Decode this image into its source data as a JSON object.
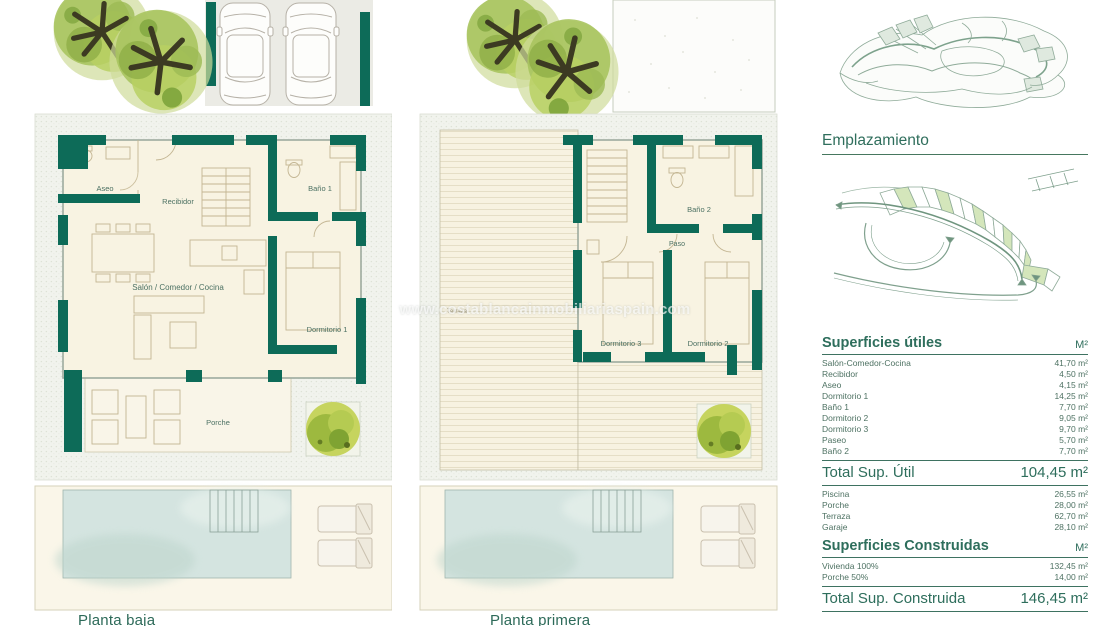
{
  "colors": {
    "wall_teal": "#0d6b58",
    "heading_teal": "#2f6e5c",
    "table_text": "#4e7263",
    "floor_cream": "#f8f3e2",
    "pool_blue": "#d4e4e0",
    "plot_speckle": "#f1f3ed",
    "map_line": "#8fab99",
    "plot_highlight": "#cfe3b0"
  },
  "plans": {
    "plan1": {
      "label": "Planta baja",
      "rooms": {
        "aseo": "Aseo",
        "recibidor": "Recibidor",
        "bano1": "Baño 1",
        "salon": "Salón / Comedor / Cocina",
        "dormitorio1": "Dormitorio 1",
        "porche": "Porche"
      }
    },
    "plan2": {
      "label": "Planta primera",
      "rooms": {
        "terraza": "Terraza",
        "bano2": "Baño 2",
        "paso": "Paso",
        "dormitorio3": "Dormitorio 3",
        "dormitorio2": "Dormitorio 2"
      }
    }
  },
  "watermark": {
    "text": "www.costablancainmobiliariaspain.com"
  },
  "sidebar": {
    "emplazamiento_title": "Emplazamiento",
    "superficies_utiles": {
      "title": "Superficies útiles",
      "unit": "M²",
      "rows": [
        {
          "label": "Salón-Comedor-Cocina",
          "value": "41,70 m²"
        },
        {
          "label": "Recibidor",
          "value": "4,50 m²"
        },
        {
          "label": "Aseo",
          "value": "4,15 m²"
        },
        {
          "label": "Dormitorio 1",
          "value": "14,25 m²"
        },
        {
          "label": "Baño 1",
          "value": "7,70 m²"
        },
        {
          "label": "Dormitorio 2",
          "value": "9,05 m²"
        },
        {
          "label": "Dormitorio 3",
          "value": "9,70 m²"
        },
        {
          "label": "Paseo",
          "value": "5,70 m²"
        },
        {
          "label": "Baño 2",
          "value": "7,70 m²"
        }
      ],
      "total_label": "Total Sup. Útil",
      "total_value": "104,45 m²"
    },
    "exterior_rows": [
      {
        "label": "Piscina",
        "value": "26,55 m²"
      },
      {
        "label": "Porche",
        "value": "28,00 m²"
      },
      {
        "label": "Terraza",
        "value": "62,70 m²"
      },
      {
        "label": "Garaje",
        "value": "28,10 m²"
      }
    ],
    "superficies_construidas": {
      "title": "Superficies Construidas",
      "unit": "M²",
      "rows": [
        {
          "label": "Vivienda 100%",
          "value": "132,45 m²"
        },
        {
          "label": "Porche 50%",
          "value": "14,00 m²"
        }
      ],
      "total_label": "Total Sup. Construida",
      "total_value": "146,45 m²"
    }
  }
}
